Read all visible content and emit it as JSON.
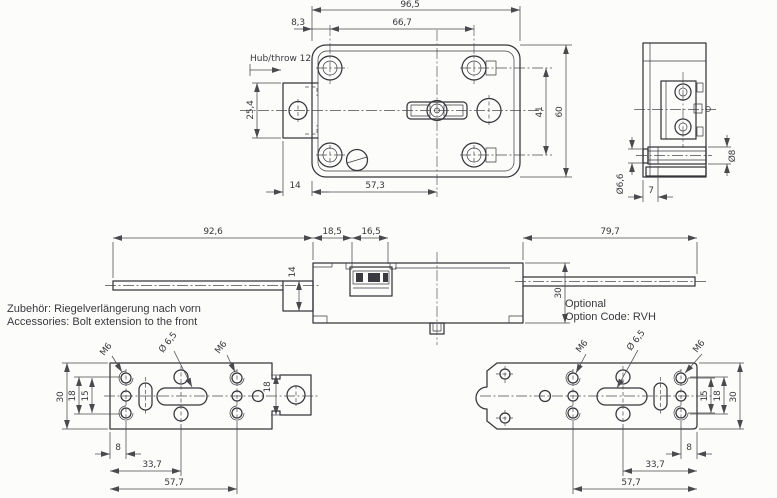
{
  "meta": {
    "kind": "technical-drawing",
    "subject": "safe lock with bolt extension accessory"
  },
  "colors": {
    "background": "#fcfcfb",
    "object_line": "#35353a",
    "dimension_line": "#4a4a4e",
    "text": "#39393d"
  },
  "notes": {
    "accessory_de": "Zubehör: Riegelverlängerung nach vorn",
    "accessory_en": "Accessories: Bolt extension to the front",
    "optional": "Optional",
    "option_code": "Option Code: RVH"
  },
  "top_view": {
    "dims": {
      "overall_width": "96,5",
      "edge_to_holes": "8,3",
      "hole_spacing": "66,7",
      "throw_label": "Hub/throw 12",
      "bolt_width": "25,4",
      "hole_row_spacing": "41",
      "overall_height": "60",
      "bolt_protrusion": "14",
      "spindle_offset": "57,3"
    }
  },
  "side_view": {
    "dims": {
      "bolt_dia": "Ø8",
      "rod_dia": "Ø6,6",
      "rod_length": "7"
    }
  },
  "profile_view": {
    "dims": {
      "rear_extension": "92,6",
      "segment_a": "18,5",
      "segment_b": "16,5",
      "bolt_height": "14",
      "case_depth": "30",
      "front_extension": "79,7"
    }
  },
  "plate_front": {
    "labels": {
      "thread_a": "M6",
      "hole_dia": "Ø 6,5",
      "thread_b": "M6"
    },
    "dims": {
      "plate_width": "30",
      "span_outer": "18",
      "span_inner": "15",
      "tab_height": "18",
      "edge_offset": "8",
      "mid_span": "33,7",
      "far_span": "57,7"
    }
  },
  "plate_rear": {
    "labels": {
      "thread_a": "M6",
      "hole_dia": "Ø 6,5",
      "thread_b": "M6"
    },
    "dims": {
      "span_inner": "15",
      "span_outer": "18",
      "plate_width": "30",
      "edge_offset": "8",
      "mid_span": "33,7",
      "far_span": "57,7"
    }
  }
}
